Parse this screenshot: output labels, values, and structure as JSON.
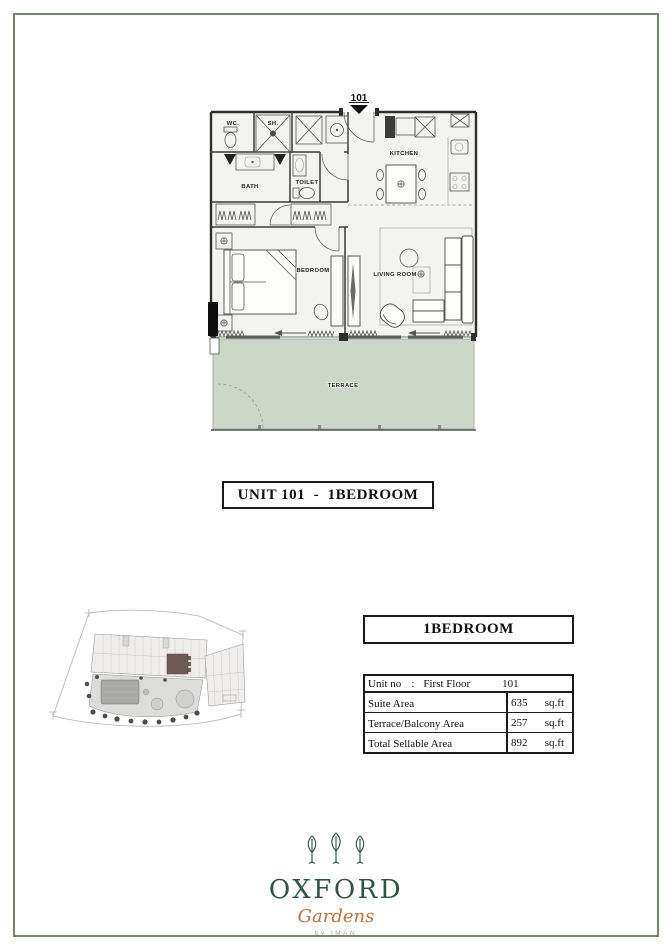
{
  "colors": {
    "frame_green": "#75856c",
    "terrace_green": "#cdd7c8",
    "logo_green": "#2d5541",
    "logo_orange": "#c06f3e",
    "byline_gray": "#aaa596"
  },
  "floor_plan": {
    "unit_marker": "101",
    "terrace_fill": "#cdd7c8",
    "rooms": {
      "wc": "WC.",
      "shower": "SH.",
      "bath": "BATH",
      "toilet": "TOILET",
      "kitchen": "KITCHEN",
      "bedroom": "BEDROOM",
      "living_room": "LIVING ROOM",
      "terrace": "TERRACE"
    }
  },
  "unit_title": "UNIT 101  -  1BEDROOM",
  "details": {
    "type_title": "1BEDROOM",
    "table": {
      "header": {
        "label": "Unit no",
        "colon": ":",
        "floor": "First Floor",
        "unit": "101"
      },
      "rows": [
        {
          "label": "Suite Area",
          "value": "635",
          "unit": "sq.ft"
        },
        {
          "label": "Terrace/Balcony Area",
          "value": "257",
          "unit": "sq.ft"
        },
        {
          "label": "Total Sellable Area",
          "value": "892",
          "unit": "sq.ft"
        }
      ]
    }
  },
  "logo": {
    "name": "OXFORD",
    "subname": "Gardens",
    "byline": "by IMAN"
  }
}
